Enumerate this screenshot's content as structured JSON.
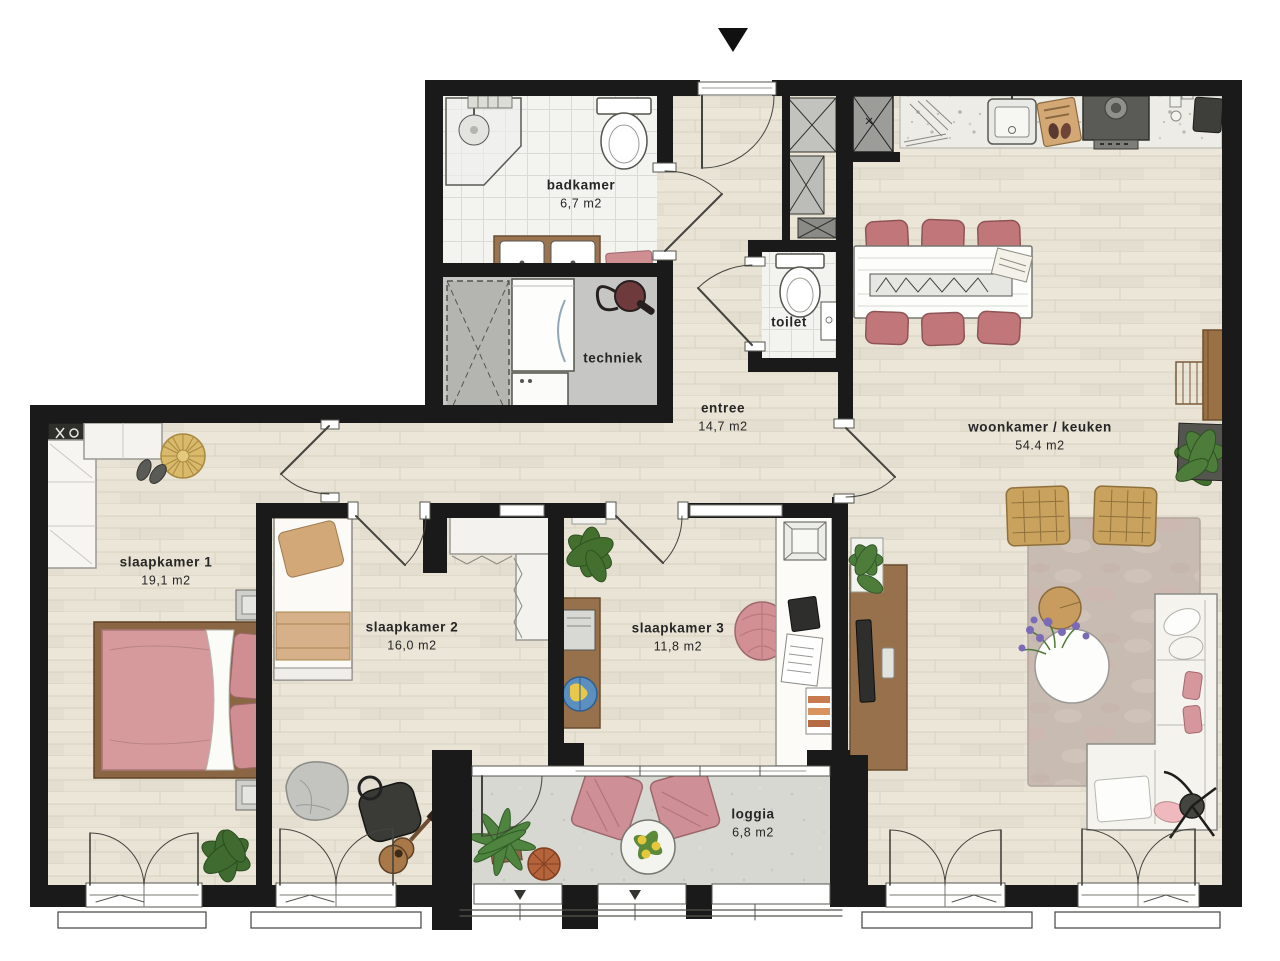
{
  "plan": {
    "title": "apartment floor plan",
    "entrance_arrow_icon": "entrance-direction-triangle",
    "rooms": {
      "badkamer": {
        "label": "badkamer",
        "area": "6,7 m2"
      },
      "techniek": {
        "label": "techniek"
      },
      "toilet": {
        "label": "toilet"
      },
      "entree": {
        "label": "entree",
        "area": "14,7 m2"
      },
      "woonkamer": {
        "label": "woonkamer / keuken",
        "area": "54.4 m2"
      },
      "slaapkamer1": {
        "label": "slaapkamer 1",
        "area": "19,1 m2"
      },
      "slaapkamer2": {
        "label": "slaapkamer 2",
        "area": "16,0 m2"
      },
      "slaapkamer3": {
        "label": "slaapkamer 3",
        "area": "11,8 m2"
      },
      "loggia": {
        "label": "loggia",
        "area": "6,8 m2"
      }
    },
    "colors": {
      "wall": "#1a1a1a",
      "wood_floor": "#e9e3d5",
      "tile_floor": "#f3f3f0",
      "techniek_floor": "#c6c6c4",
      "concrete_floor": "#d8d8d3",
      "counter_terrazzo": "#edece6",
      "bed_pink": "#d79a9c",
      "chair_red": "#c17779",
      "pillow_tan": "#d2a878",
      "rattan": "#c9a35e",
      "plant_green": "#4a7a38",
      "rug": "#c8bbb1",
      "furniture_brown": "#96714b"
    }
  }
}
